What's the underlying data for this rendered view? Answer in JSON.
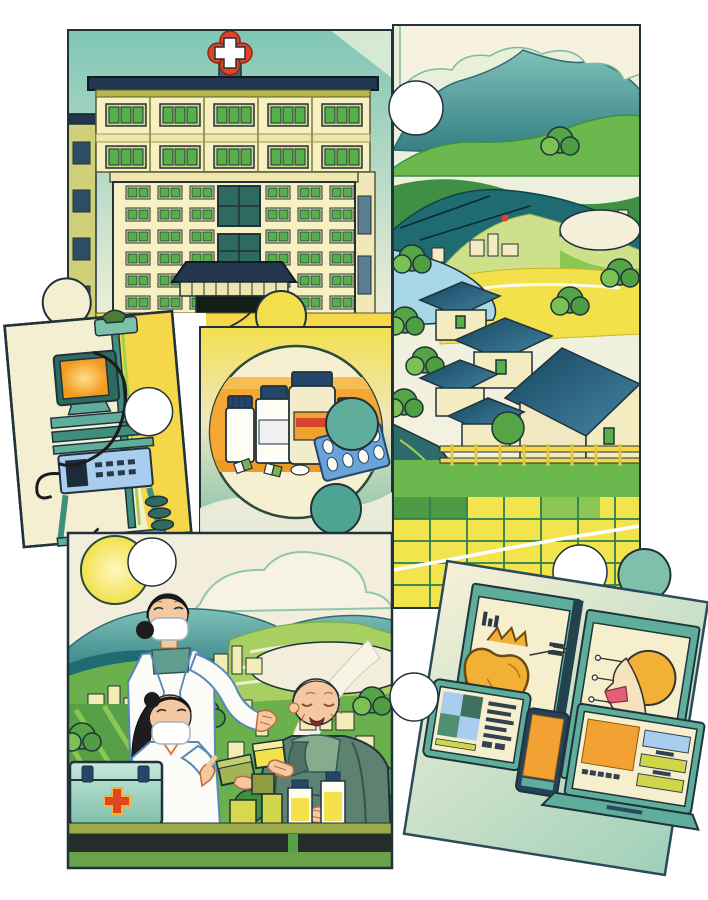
{
  "artwork": {
    "theme": "Rural healthcare jigsaw puzzle illustration",
    "background_color": "#ffffff",
    "pieces": [
      {
        "id": "hospital",
        "label": "Township hospital building with red medical cross emblem"
      },
      {
        "id": "countryside",
        "label": "Mountain village landscape with houses, lake, terraced yellow fields and paddy grid"
      },
      {
        "id": "equipment",
        "label": "Mobile medical equipment cart with monitor and instrument box"
      },
      {
        "id": "medicines",
        "label": "Circular badge with medicine bottles, jar and blister pack of pills"
      },
      {
        "id": "doctors",
        "label": "Two masked doctors handing medicine boxes to a smiling elderly villager beside a first-aid kit"
      },
      {
        "id": "telemedicine",
        "label": "Telemedicine screens showing heart and head diagnostics with tablet, phone and laptop"
      }
    ],
    "icons": [
      {
        "name": "red-cross-emblem-icon",
        "color": "#e04427"
      },
      {
        "name": "first-aid-cross-icon",
        "color": "#e04427"
      },
      {
        "name": "sun-icon",
        "color": "#f2e14b"
      },
      {
        "name": "heart-diagram-icon",
        "color": "#f2b135"
      },
      {
        "name": "head-scan-icon",
        "color": "#f2b135"
      }
    ],
    "palette": {
      "outline": "#20323c",
      "cream": "#f4f0da",
      "yellow": "#f2e14b",
      "golden": "#f6d74a",
      "orange_band": "#f5a733",
      "teal": "#5fae9c",
      "deep_teal": "#2e6b74",
      "navy_roof": "#24364e",
      "green": "#6ab04c",
      "dark_green": "#3f8f44",
      "lake_blue": "#a8d8e8",
      "device_blue": "#a9cdee",
      "skin": "#f4c9a1",
      "red": "#e04427",
      "white": "#ffffff",
      "screen_orange": "#f2a233"
    }
  }
}
